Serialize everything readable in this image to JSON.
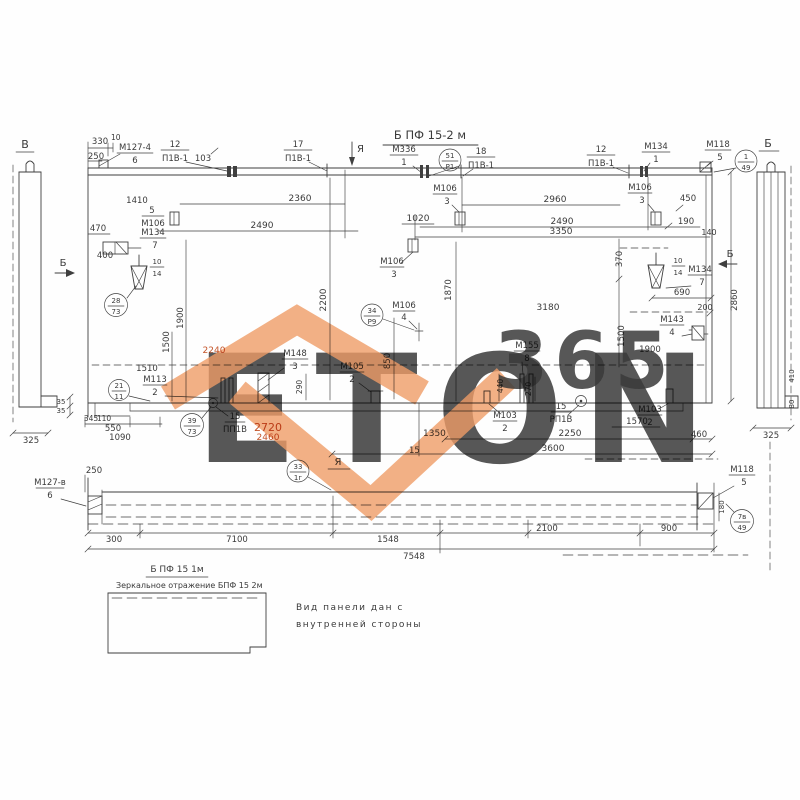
{
  "colors": {
    "ink": "#3f3f3f",
    "red": "#c4552a",
    "watermark_orange": "#f09d68",
    "watermark_gray": "#e0e0e0"
  },
  "watermark": {
    "letters": "ETON",
    "digits": "365"
  },
  "title": {
    "main": "Б ПФ 15-2 м"
  },
  "view_labels": {
    "left_section": "В",
    "right_section": "Б",
    "cut_left": "Б",
    "cut_right": "Б",
    "top_arrow": "Я",
    "bottom_view": "Я"
  },
  "callouts": {
    "m127_top": {
      "mark": "М127-4",
      "pos": "6"
    },
    "m127_bottom": {
      "mark": "М127-в",
      "pos": "6"
    },
    "p1v_a": {
      "num": "12",
      "mark": "П1В-1"
    },
    "p1v_b": {
      "num": "17",
      "mark": "П1В-1"
    },
    "p1v_c": {
      "num": "18",
      "mark": "П1В-1"
    },
    "p1v_d": {
      "num": "12",
      "mark": "П1В-1"
    },
    "m336": {
      "mark": "М336",
      "pos": "1"
    },
    "m134_top": {
      "mark": "М134",
      "pos": "1"
    },
    "m118_top": {
      "mark": "М118",
      "pos": "5"
    },
    "m118_bottom": {
      "mark": "М118",
      "pos": "5"
    },
    "m106_5": {
      "pos": "5",
      "mark": "М106"
    },
    "m106_3a": {
      "mark": "М106",
      "pos": "3"
    },
    "m106_3b": {
      "mark": "М106",
      "pos": "3"
    },
    "m106_3c": {
      "mark": "М106",
      "pos": "3"
    },
    "m106_4": {
      "mark": "М106",
      "pos": "4"
    },
    "m134_7L": {
      "mark": "М134",
      "pos": "7"
    },
    "m134_7R": {
      "mark": "М134",
      "pos": "7"
    },
    "m113": {
      "mark": "М113",
      "pos": "2"
    },
    "m148": {
      "mark": "М148",
      "pos": "3"
    },
    "m105": {
      "mark": "М105",
      "pos": "2"
    },
    "m155": {
      "mark": "М155",
      "pos": "8"
    },
    "m103_mid": {
      "mark": "М103",
      "pos": "2"
    },
    "m103_right": {
      "mark": "М103",
      "pos": "2"
    },
    "m143": {
      "mark": "М143",
      "pos": "4"
    },
    "hole_left": {
      "num": "15",
      "mark": "ПП1В"
    },
    "hole_right": {
      "num": "15",
      "mark": "РП1В"
    }
  },
  "refs": {
    "r51": {
      "top": "51",
      "bottom": "Р1"
    },
    "r1": {
      "top": "1",
      "bottom": "49"
    },
    "r28": {
      "top": "28",
      "bottom": "73"
    },
    "r21": {
      "top": "21",
      "bottom": "11"
    },
    "r34": {
      "top": "34",
      "bottom": "Р9"
    },
    "r39": {
      "top": "39",
      "bottom": "73"
    },
    "r33": {
      "top": "33",
      "bottom": "1г"
    },
    "r7v": {
      "top": "7в",
      "bottom": "49"
    },
    "f14L": {
      "top": "10",
      "bottom": "14"
    },
    "f14R": {
      "top": "10",
      "bottom": "14"
    }
  },
  "dims": {
    "d330": "330",
    "d10": "10",
    "d250": "250",
    "d103": "103",
    "d1410": "1410",
    "d2360": "2360",
    "d2960": "2960",
    "d2490L": "2490",
    "d1020": "1020",
    "d2490R": "2490",
    "d3350": "3350",
    "d450": "450",
    "d190": "190",
    "d140": "140",
    "d470": "470",
    "d400": "400",
    "v2200": "2200",
    "v1900L": "1900",
    "v1500L": "1500",
    "v1870": "1870",
    "v850": "850",
    "v370": "370",
    "v1500R": "1500",
    "v2860": "2860",
    "v290": "290",
    "v440": "440",
    "v270": "270",
    "d2240": "2240",
    "d3180": "3180",
    "d1900R": "1900",
    "d690": "690",
    "d200": "200",
    "d1510": "1510",
    "d345": "345",
    "d110": "110",
    "d550": "550",
    "d1090": "1090",
    "d35a": "35",
    "d35b": "35",
    "d2720": "2720",
    "d2460": "2460",
    "d1350": "1350",
    "d15": "15",
    "d1570": "1570",
    "d2250": "2250",
    "d460": "460",
    "d3600": "3600",
    "bv250": "250",
    "bv300": "300",
    "bv7100": "7100",
    "bv1548": "1548",
    "bv2100": "2100",
    "bv900": "900",
    "bv7548": "7548",
    "bv180": "180",
    "ls325": "325",
    "rs325": "325",
    "rs410": "410",
    "rs80": "80"
  },
  "notes": {
    "alt_title": "Б ПФ 15 1м",
    "mirror": "Зеркальное отражение БПФ 15 2м",
    "line1": "Вид панели дан с",
    "line2": "внутренней стороны"
  }
}
